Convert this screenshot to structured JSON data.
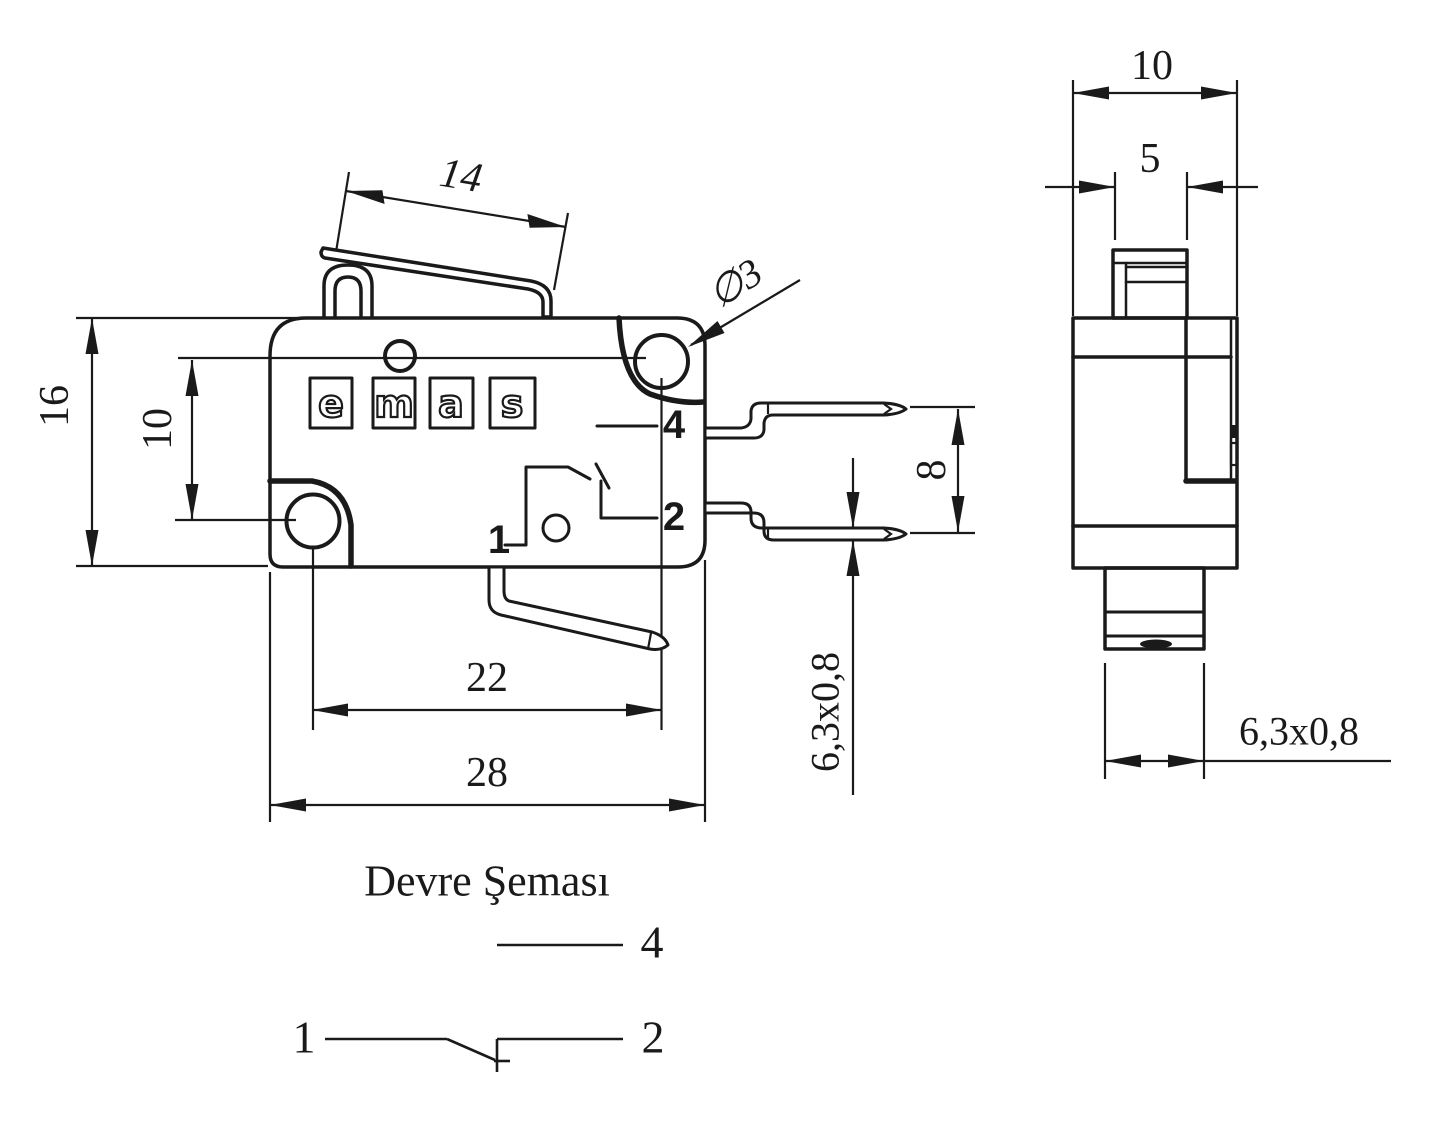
{
  "colors": {
    "line": "#1a1a1a",
    "background": "#ffffff"
  },
  "logo": {
    "letters": [
      "e",
      "m",
      "a",
      "s"
    ]
  },
  "front_view": {
    "dims": {
      "lever_length": "14",
      "body_height": "16",
      "hole_offset": "10",
      "hole_spacing": "22",
      "body_width": "28",
      "hole_diameter": "∅3",
      "terminal_pitch": "8",
      "terminal_size": "6,3x0,8"
    },
    "molded_labels": {
      "terminal_4": "4",
      "terminal_2": "2",
      "terminal_1": "1"
    }
  },
  "side_view": {
    "dims": {
      "body_depth": "10",
      "plunger_width": "5",
      "terminal_size": "6,3x0,8"
    }
  },
  "circuit_diagram": {
    "title": "Devre Şeması",
    "labels": {
      "terminal_4": "4",
      "terminal_1": "1",
      "terminal_2": "2"
    }
  }
}
